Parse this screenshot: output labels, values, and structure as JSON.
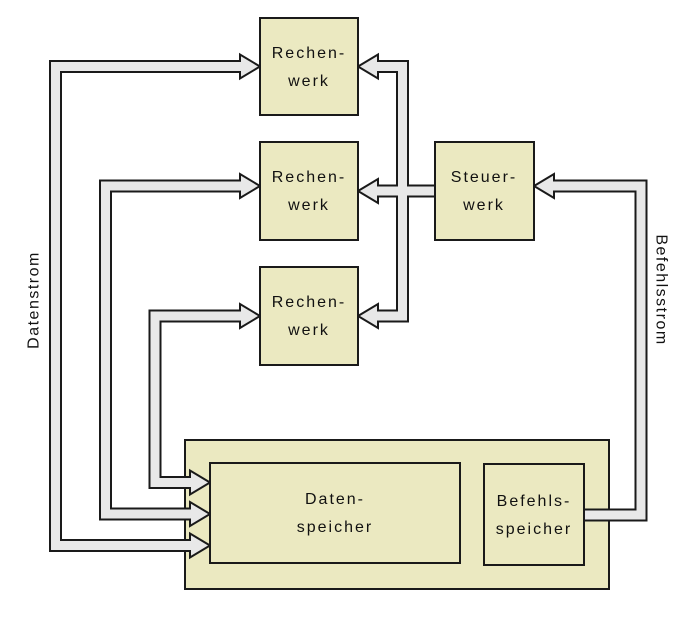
{
  "colors": {
    "background": "#ffffff",
    "box_fill": "#ebe9c1",
    "box_border": "#1a1a1a",
    "arrow_fill": "#e8e8e8",
    "arrow_outline": "#1a1a1a",
    "text": "#111111"
  },
  "nodes": {
    "rechenwerk_top": {
      "line1": "Rechen-",
      "line2": "werk"
    },
    "rechenwerk_middle": {
      "line1": "Rechen-",
      "line2": "werk"
    },
    "rechenwerk_bottom": {
      "line1": "Rechen-",
      "line2": "werk"
    },
    "steuerwerk": {
      "line1": "Steuer-",
      "line2": "werk"
    },
    "datenspeicher": {
      "line1": "Daten-",
      "line2": "speicher"
    },
    "befehlsspeicher": {
      "line1": "Befehls-",
      "line2": "speicher"
    }
  },
  "stream_labels": {
    "left": "Datenstrom",
    "right": "Befehlsstrom"
  },
  "edges": [
    {
      "between": [
        "Datenspeicher",
        "Rechenwerk (top)"
      ],
      "arrows": "both-ends"
    },
    {
      "between": [
        "Datenspeicher",
        "Rechenwerk (middle)"
      ],
      "arrows": "both-ends"
    },
    {
      "between": [
        "Datenspeicher",
        "Rechenwerk (bottom)"
      ],
      "arrows": "both-ends"
    },
    {
      "from": "Steuerwerk",
      "to": "Rechenwerk (top)",
      "arrows": "single"
    },
    {
      "from": "Steuerwerk",
      "to": "Rechenwerk (middle)",
      "arrows": "single"
    },
    {
      "from": "Steuerwerk",
      "to": "Rechenwerk (bottom)",
      "arrows": "single"
    },
    {
      "from": "Befehlsspeicher",
      "to": "Steuerwerk",
      "arrows": "single"
    }
  ]
}
